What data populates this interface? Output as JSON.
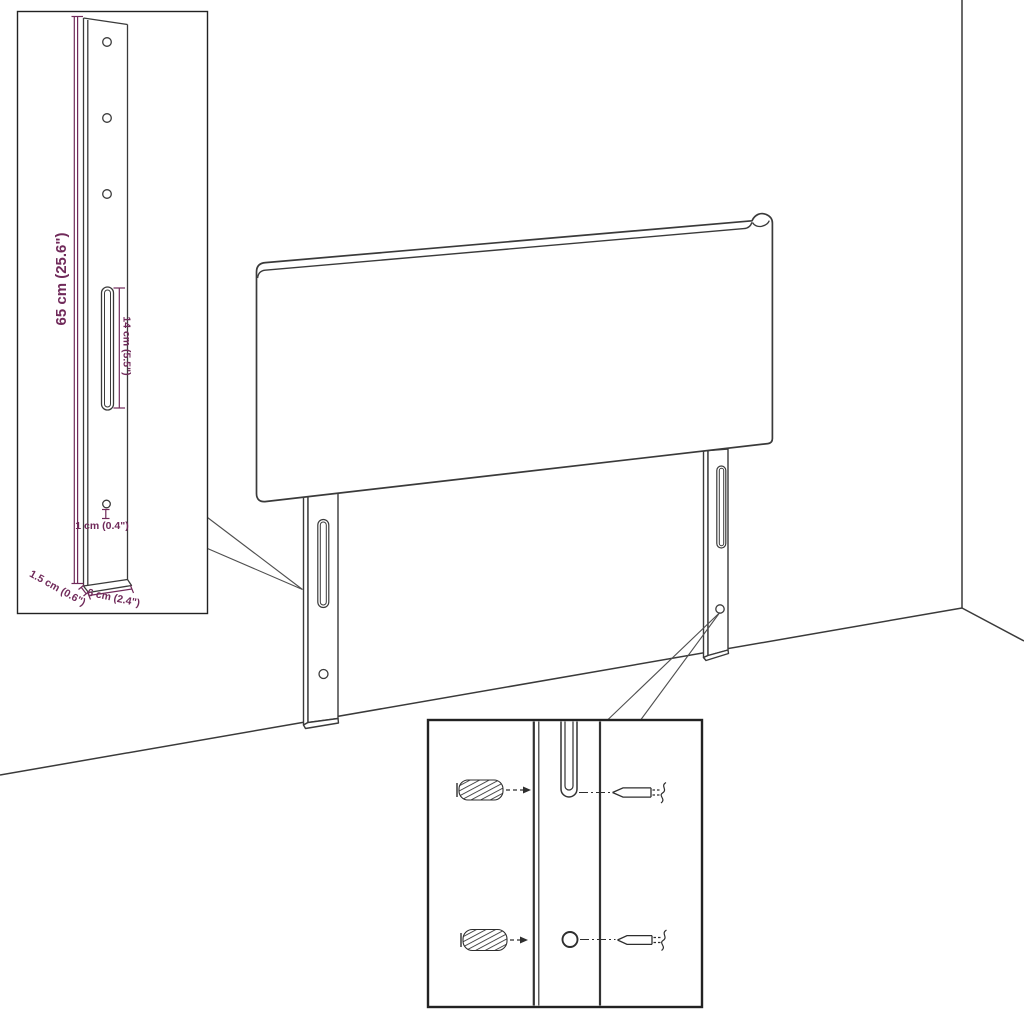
{
  "diagram": {
    "background": "#ffffff",
    "line_color": "#3a3a3a",
    "dimension_color": "#702a5a",
    "inset_border_color": "#222222",
    "labels": {
      "bracket_height": "65 cm (25.6\")",
      "slot_length": "14 cm (5.5\")",
      "hole_offset": "1 cm (0.4\")",
      "bracket_depth": "1.5 cm (0.6\")",
      "bracket_width": "6 cm (2.4\")"
    }
  }
}
